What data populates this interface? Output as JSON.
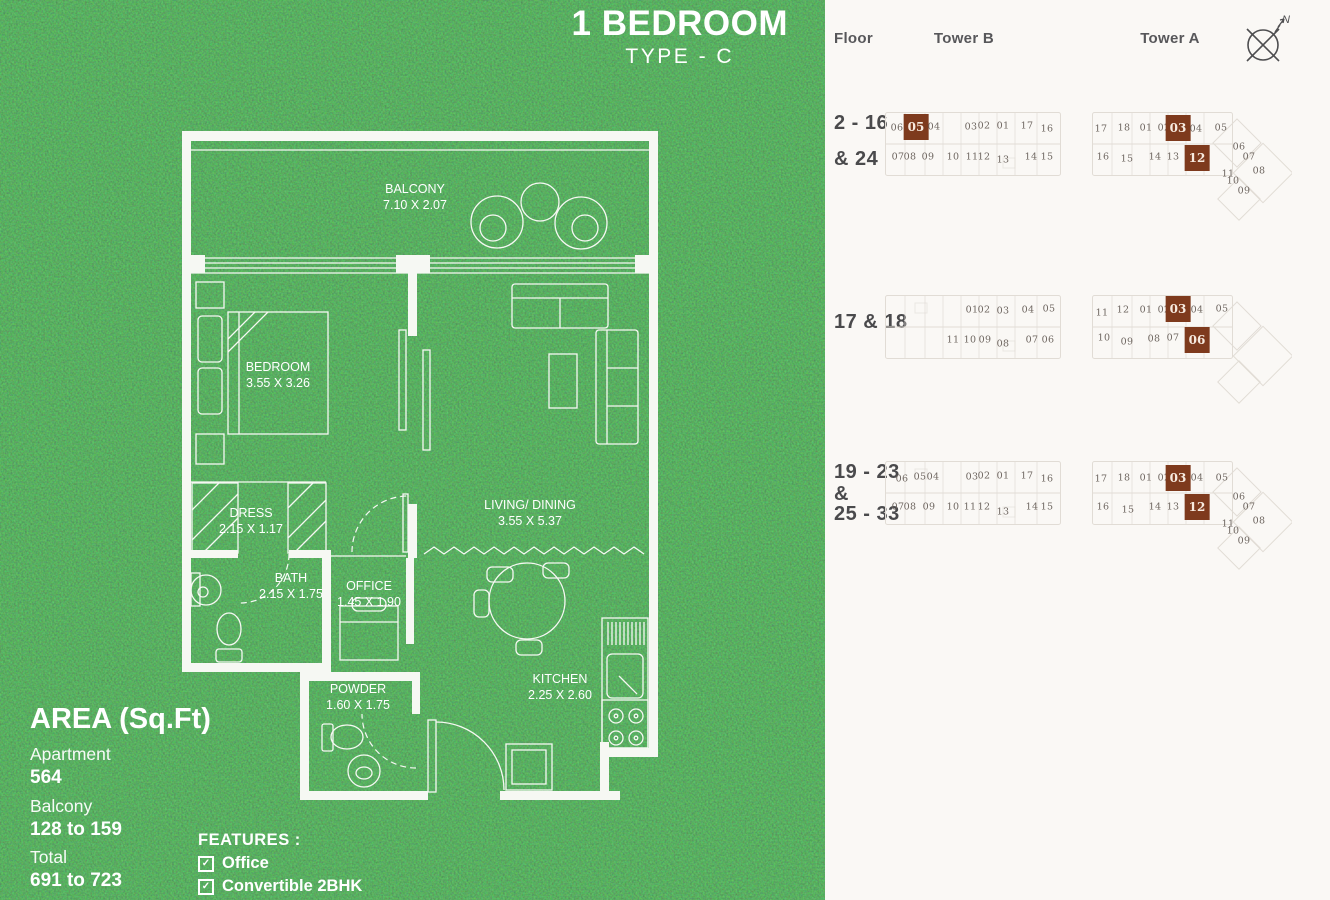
{
  "title": {
    "main": "1 BEDROOM",
    "sub": "TYPE - C"
  },
  "area_panel": {
    "heading": "AREA (Sq.Ft)",
    "items": [
      {
        "label": "Apartment",
        "value": "564"
      },
      {
        "label": "Balcony",
        "value": "128 to 159"
      },
      {
        "label": "Total",
        "value": "691 to 723"
      }
    ]
  },
  "features": {
    "heading": "FEATURES :",
    "items": [
      "Office",
      "Convertible 2BHK"
    ]
  },
  "floorplan": {
    "rooms": [
      {
        "id": "balcony",
        "name": "BALCONY",
        "dims": "7.10 X 2.07",
        "x": 415,
        "y": 197
      },
      {
        "id": "bedroom",
        "name": "BEDROOM",
        "dims": "3.55 X 3.26",
        "x": 278,
        "y": 375
      },
      {
        "id": "dress",
        "name": "DRESS",
        "dims": "2.15 X 1.17",
        "x": 251,
        "y": 521
      },
      {
        "id": "bath",
        "name": "BATH",
        "dims": "2.15 X 1.75",
        "x": 291,
        "y": 586
      },
      {
        "id": "office",
        "name": "OFFICE",
        "dims": "1.45 X 1.90",
        "x": 369,
        "y": 594
      },
      {
        "id": "living",
        "name": "LIVING/ DINING",
        "dims": "3.55 X 5.37",
        "x": 530,
        "y": 513
      },
      {
        "id": "powder",
        "name": "POWDER",
        "dims": "1.60 X 1.75",
        "x": 358,
        "y": 697
      },
      {
        "id": "kitchen",
        "name": "KITCHEN",
        "dims": "2.25 X 2.60",
        "x": 560,
        "y": 687
      }
    ]
  },
  "keyplan_panel": {
    "headers": {
      "floor": "Floor",
      "tower_b": "Tower B",
      "tower_a": "Tower A"
    },
    "north_label": "N",
    "highlight_color": "#7E3A1D",
    "rows": [
      {
        "floor_lines": [
          "2 - 16",
          "& 24"
        ],
        "tower_b_units": [
          {
            "n": "06",
            "x": 72,
            "y": 128
          },
          {
            "n": "05",
            "x": 91,
            "y": 127,
            "hl": true
          },
          {
            "n": "04",
            "x": 109,
            "y": 127
          },
          {
            "n": "03",
            "x": 146,
            "y": 127
          },
          {
            "n": "02",
            "x": 159,
            "y": 126
          },
          {
            "n": "01",
            "x": 178,
            "y": 126
          },
          {
            "n": "17",
            "x": 202,
            "y": 126
          },
          {
            "n": "16",
            "x": 222,
            "y": 129
          },
          {
            "n": "07",
            "x": 73,
            "y": 157
          },
          {
            "n": "08",
            "x": 85,
            "y": 157
          },
          {
            "n": "09",
            "x": 103,
            "y": 157
          },
          {
            "n": "10",
            "x": 128,
            "y": 157
          },
          {
            "n": "11",
            "x": 147,
            "y": 157
          },
          {
            "n": "12",
            "x": 159,
            "y": 157
          },
          {
            "n": "13",
            "x": 178,
            "y": 160
          },
          {
            "n": "14",
            "x": 206,
            "y": 157
          },
          {
            "n": "15",
            "x": 222,
            "y": 157
          }
        ],
        "tower_a_units": [
          {
            "n": "17",
            "x": 276,
            "y": 129
          },
          {
            "n": "18",
            "x": 299,
            "y": 128
          },
          {
            "n": "01",
            "x": 321,
            "y": 128
          },
          {
            "n": "02",
            "x": 339,
            "y": 128
          },
          {
            "n": "03",
            "x": 353,
            "y": 128,
            "hl": true
          },
          {
            "n": "04",
            "x": 371,
            "y": 129
          },
          {
            "n": "05",
            "x": 396,
            "y": 128
          },
          {
            "n": "16",
            "x": 278,
            "y": 157
          },
          {
            "n": "15",
            "x": 302,
            "y": 159
          },
          {
            "n": "14",
            "x": 330,
            "y": 157
          },
          {
            "n": "13",
            "x": 348,
            "y": 157
          },
          {
            "n": "12",
            "x": 372,
            "y": 158,
            "hl": true
          },
          {
            "n": "06",
            "x": 414,
            "y": 147
          },
          {
            "n": "07",
            "x": 424,
            "y": 157
          },
          {
            "n": "08",
            "x": 434,
            "y": 171
          },
          {
            "n": "11",
            "x": 403,
            "y": 174
          },
          {
            "n": "10",
            "x": 408,
            "y": 181
          },
          {
            "n": "09",
            "x": 419,
            "y": 191
          }
        ]
      },
      {
        "floor_lines": [
          "17 & 18"
        ],
        "tower_b_units": [
          {
            "n": "01",
            "x": 147,
            "y": 310
          },
          {
            "n": "02",
            "x": 159,
            "y": 310
          },
          {
            "n": "03",
            "x": 178,
            "y": 311
          },
          {
            "n": "04",
            "x": 203,
            "y": 310
          },
          {
            "n": "05",
            "x": 224,
            "y": 309
          },
          {
            "n": "11",
            "x": 128,
            "y": 340
          },
          {
            "n": "10",
            "x": 145,
            "y": 340
          },
          {
            "n": "09",
            "x": 160,
            "y": 340
          },
          {
            "n": "08",
            "x": 178,
            "y": 344
          },
          {
            "n": "07",
            "x": 207,
            "y": 340
          },
          {
            "n": "06",
            "x": 223,
            "y": 340
          }
        ],
        "tower_a_units": [
          {
            "n": "11",
            "x": 277,
            "y": 313
          },
          {
            "n": "12",
            "x": 298,
            "y": 310
          },
          {
            "n": "01",
            "x": 321,
            "y": 310
          },
          {
            "n": "02",
            "x": 339,
            "y": 310
          },
          {
            "n": "03",
            "x": 353,
            "y": 309,
            "hl": true
          },
          {
            "n": "04",
            "x": 372,
            "y": 310
          },
          {
            "n": "05",
            "x": 397,
            "y": 309
          },
          {
            "n": "10",
            "x": 279,
            "y": 338
          },
          {
            "n": "09",
            "x": 302,
            "y": 342
          },
          {
            "n": "08",
            "x": 329,
            "y": 339
          },
          {
            "n": "07",
            "x": 348,
            "y": 338
          },
          {
            "n": "06",
            "x": 372,
            "y": 340,
            "hl": true
          }
        ]
      },
      {
        "floor_lines": [
          "19 - 23",
          "&",
          "25 - 33"
        ],
        "tower_b_units": [
          {
            "n": "06",
            "x": 77,
            "y": 479
          },
          {
            "n": "05",
            "x": 95,
            "y": 477
          },
          {
            "n": "04",
            "x": 108,
            "y": 477
          },
          {
            "n": "03",
            "x": 147,
            "y": 477
          },
          {
            "n": "02",
            "x": 159,
            "y": 476
          },
          {
            "n": "01",
            "x": 178,
            "y": 476
          },
          {
            "n": "17",
            "x": 202,
            "y": 476
          },
          {
            "n": "16",
            "x": 222,
            "y": 479
          },
          {
            "n": "07",
            "x": 73,
            "y": 507
          },
          {
            "n": "08",
            "x": 85,
            "y": 507
          },
          {
            "n": "09",
            "x": 104,
            "y": 507
          },
          {
            "n": "10",
            "x": 128,
            "y": 507
          },
          {
            "n": "11",
            "x": 145,
            "y": 507
          },
          {
            "n": "12",
            "x": 159,
            "y": 507
          },
          {
            "n": "13",
            "x": 178,
            "y": 512
          },
          {
            "n": "14",
            "x": 207,
            "y": 507
          },
          {
            "n": "15",
            "x": 222,
            "y": 507
          }
        ],
        "tower_a_units": [
          {
            "n": "17",
            "x": 276,
            "y": 479
          },
          {
            "n": "18",
            "x": 299,
            "y": 478
          },
          {
            "n": "01",
            "x": 321,
            "y": 478
          },
          {
            "n": "02",
            "x": 339,
            "y": 478
          },
          {
            "n": "03",
            "x": 353,
            "y": 478,
            "hl": true
          },
          {
            "n": "04",
            "x": 372,
            "y": 478
          },
          {
            "n": "05",
            "x": 397,
            "y": 478
          },
          {
            "n": "16",
            "x": 278,
            "y": 507
          },
          {
            "n": "15",
            "x": 303,
            "y": 510
          },
          {
            "n": "14",
            "x": 330,
            "y": 507
          },
          {
            "n": "13",
            "x": 348,
            "y": 507
          },
          {
            "n": "12",
            "x": 372,
            "y": 507,
            "hl": true
          },
          {
            "n": "06",
            "x": 414,
            "y": 497
          },
          {
            "n": "07",
            "x": 424,
            "y": 507
          },
          {
            "n": "08",
            "x": 434,
            "y": 521
          },
          {
            "n": "11",
            "x": 403,
            "y": 524
          },
          {
            "n": "10",
            "x": 408,
            "y": 531
          },
          {
            "n": "09",
            "x": 419,
            "y": 541
          }
        ]
      }
    ]
  }
}
